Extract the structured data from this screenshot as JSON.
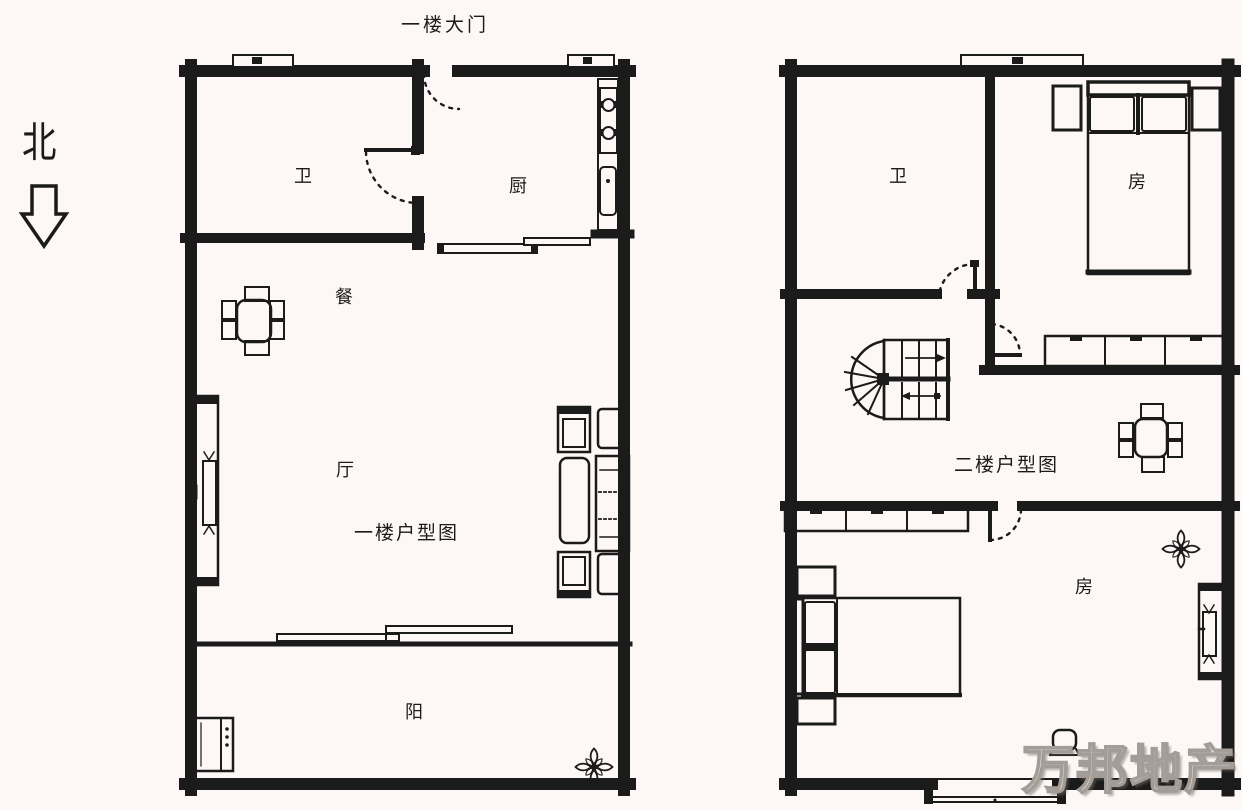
{
  "meta": {
    "type": "floor-plan",
    "language": "zh-CN"
  },
  "colors": {
    "background": "#fdf8f6",
    "line": "#1b1b1b",
    "watermark_fill": "#f7f3ef",
    "watermark_outline": "#a49d97"
  },
  "compass": {
    "north_label": "北",
    "arrow_direction": "down"
  },
  "entry": {
    "label": "一楼大门"
  },
  "watermark": {
    "text": "万邦地产"
  },
  "floor1": {
    "plan_label": "一楼户型图",
    "rooms": {
      "bathroom": "卫",
      "kitchen": "厨",
      "dining": "餐",
      "living": "厅",
      "balcony": "阳"
    }
  },
  "floor2": {
    "plan_label": "二楼户型图",
    "rooms": {
      "bathroom": "卫",
      "bedroom_upper": "房",
      "bedroom_lower": "房"
    }
  }
}
